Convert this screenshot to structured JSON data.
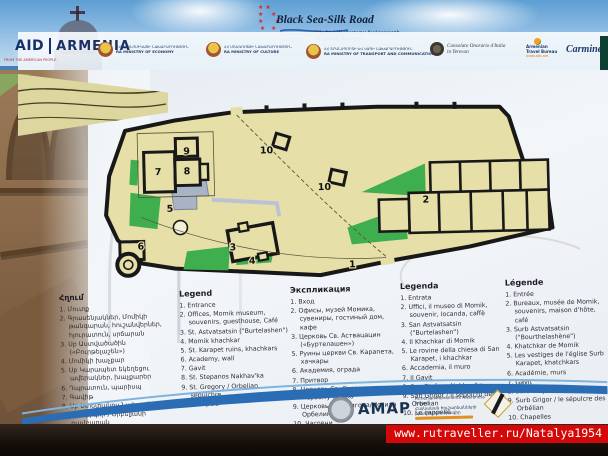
{
  "header": {
    "silk_road": {
      "title": "Black Sea-Silk Road",
      "corridor": "corridor",
      "subtitle_line1": "Սև ծով-Մետաքսյա ճանապարհ",
      "subtitle_line2": "միջանցք ծրագիր"
    },
    "partners": [
      {
        "id": "usaid",
        "aid": "AID",
        "country": "ARMENIA",
        "tagline": "FROM THE AMERICAN PEOPLE"
      },
      {
        "id": "ministry-economy",
        "line_hy": "ՀՀ ԷԿՈՆՈՄԻԿԱՅԻ ՆԱԽԱՐԱՐՈՒԹՅՈՒՆ",
        "line_en": "RA MINISTRY OF ECONOMY"
      },
      {
        "id": "ministry-culture",
        "line_hy": "ՀՀ ՄՇԱԿՈՒՅԹԻ ՆԱԽԱՐԱՐՈՒԹՅՈՒՆ",
        "line_en": "RA MINISTRY OF CULTURE"
      },
      {
        "id": "ministry-transport",
        "line_hy": "ՀՀ ՏՐԱՆՍՊՈՐՏԻ ԵՎ ԿԱՊԻ ՆԱԽԱՐԱՐՈՒԹՅՈՒՆ",
        "line_en": "RA MINISTRY OF TRANSPORT AND COMMUNICATION"
      },
      {
        "id": "italy-consulate",
        "line1": "Consolato Onorario d'Italia",
        "line2": "in Yerevan"
      },
      {
        "id": "armenian-travel-bureau",
        "line1": "Armenian",
        "line2": "Travel Bureau",
        "url": "www.atb.am"
      },
      {
        "id": "carmineo",
        "name": "Carmineo"
      }
    ]
  },
  "map": {
    "markers": [
      {
        "label": "1",
        "x": 272,
        "y": 175
      },
      {
        "label": "2",
        "x": 347,
        "y": 112
      },
      {
        "label": "3",
        "x": 153,
        "y": 155
      },
      {
        "label": "4",
        "x": 172,
        "y": 169
      },
      {
        "label": "5",
        "x": 91,
        "y": 115
      },
      {
        "label": "6",
        "x": 61,
        "y": 152
      },
      {
        "label": "7",
        "x": 80,
        "y": 78
      },
      {
        "label": "8",
        "x": 109,
        "y": 78
      },
      {
        "label": "9",
        "x": 109,
        "y": 58
      },
      {
        "label": "10",
        "x": 189,
        "y": 59
      },
      {
        "label": "10",
        "x": 246,
        "y": 97
      }
    ],
    "colors": {
      "yard": "#e6dfa8",
      "wall": "#181818",
      "green": "#3fae4e",
      "ruins": "#a9b3c6"
    }
  },
  "legend_columns": [
    {
      "lang": "hy",
      "title": "Հղում",
      "items": [
        "1. Մուտք",
        "2. Գրասենյակներ, Մոմիկի թանգարան, հուշանվերներ, հյուրատուն, սրճարան",
        "3. Սբ Աստվածածին («Բուրթելաշեն»)",
        "4. Մոմիկի խաչքար",
        "5. Սբ Կարապետ եկեղեցու ավերակներ, խաչքարեր",
        "6. Դպրատուն, պարիսպ",
        "7. Գավիթ",
        "8. Սբ Ստեփանոս Նախավկա",
        "9. Սբ Գրիգոր / Օրբելյանի դամբարան",
        "10. Մատուռներ"
      ]
    },
    {
      "lang": "en",
      "title": "Legend",
      "items": [
        "1. Entrance",
        "2. Offices, Momik museum, souvenirs, guesthouse, Café",
        "3. St. Astvatsatsin (\"Burtelashen\")",
        "4. Momik khachkar",
        "5. St. Karapet ruins, khachkars",
        "6. Academy, wall",
        "7. Gavit",
        "8. St. Stepanos Nakhav'ka",
        "9. St. Gregory / Orbelian sepulchre",
        "10. Chapels"
      ]
    },
    {
      "lang": "ru",
      "title": "Экспликация",
      "items": [
        "1. Вход",
        "2. Офисы, музей Момика, сувениры, гостиный дом, кафе",
        "3. Церковь Св. Аствацацин («Буртелашен»)",
        "5. Руины церкви Св. Карапета, хачкары",
        "6. Академия, ограда",
        "7. Притвор",
        "8. Церковь Св. Степаноса Первомученика",
        "9. Церковь Св. Григора/Могила Орбелина",
        "10. Часовни"
      ]
    },
    {
      "lang": "it",
      "title": "Legenda",
      "items": [
        "1. Entrata",
        "2. Uffici, il museo di Momik, souvenir, locanda, caffè",
        "3. San Astvatsatsin (\"Burtelashen\")",
        "4. Il Khachkar di Momik",
        "5. Le rovine della chiesa di San Karapet, i khachkar",
        "6. Accademia, il muro",
        "7. Il Gavit",
        "8. San Stefano Nakhav'ka",
        "9. San Grigor / Il sepolcro degli Orbelian",
        "10. Le cappelle"
      ]
    },
    {
      "lang": "fr",
      "title": "Légende",
      "items": [
        "1. Entrée",
        "2. Bureaux, musée de Momik, souvenirs, maison d'hôte, café",
        "3. Surb Astvatsatsin (\"Bourthelashène\")",
        "4. Khatchkar de Momik",
        "5. Les vestiges de l'église Surb Karapet, khatchkars",
        "6. Académie, murs",
        "7. Gavit",
        "8. Surb Stépanos Nakhavaka",
        "9. Surb Grigor / le sépulcre des Orbélian",
        "10. Chapelles"
      ]
    }
  ],
  "footer": {
    "amap_acronym": "AMAP",
    "amap_line1": "Armenian Monuments Awareness Project",
    "amap_line2": "Հայկական հուշարձանների իրազեկման ծրագիր",
    "watermark": "www.rutraveller.ru/Natalya1954"
  }
}
